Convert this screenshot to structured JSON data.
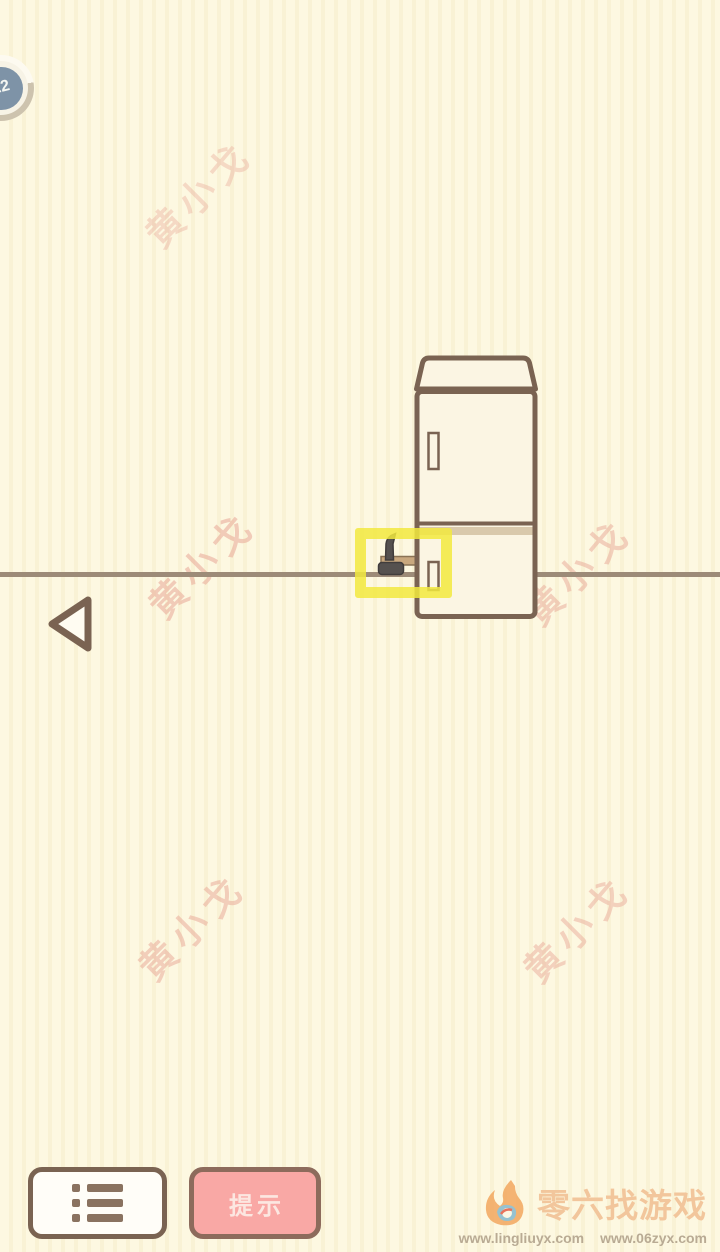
{
  "hud": {
    "level_badge": "22"
  },
  "watermark": {
    "text": "黄小戈",
    "color": "#e9a897"
  },
  "scene": {
    "items": {
      "fridge": "refrigerator",
      "hammer": "hammer",
      "highlight": "yellow-highlight-box"
    },
    "colors": {
      "outline": "#7a6352",
      "highlight": "#f2e93e",
      "floor_line": "#9d8b78",
      "fridge_fill": "#fbf5e3"
    }
  },
  "controls": {
    "hint_label": "提示",
    "menu_icon": "list-menu-icon",
    "back_icon": "back-arrow-icon"
  },
  "branding": {
    "logo_icon": "flame-logo-icon",
    "logo_text": "零六找游戏",
    "urls": [
      "www.lingliuyx.com",
      "www.06zyx.com"
    ]
  }
}
